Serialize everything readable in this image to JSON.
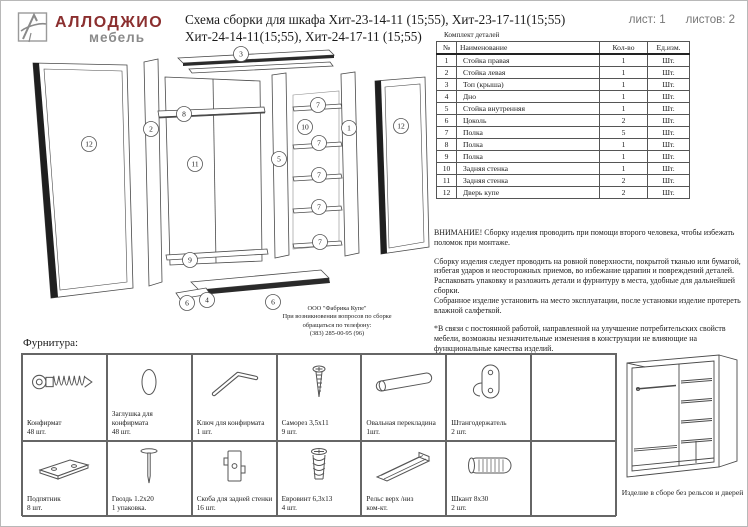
{
  "header": {
    "brand": "АЛЛОДЖИО",
    "brand_sub": "мебель",
    "title_line1": "Схема сборки для шкафа Хит-23-14-11 (15;55), Хит-23-17-11(15;55)",
    "title_line2": "Хит-24-14-11(15;55), Хит-24-17-11 (15;55)",
    "sheet_label": "лист: 1",
    "sheets_label": "листов: 2"
  },
  "colors": {
    "brand": "#8b2f2f",
    "brand_sub": "#8a8a8a",
    "line_art": "#4a4a4a"
  },
  "parts_table": {
    "caption": "Комплект деталей",
    "columns": [
      "№",
      "Наименование",
      "Кол-во",
      "Ед.изм."
    ],
    "rows": [
      [
        "1",
        "Стойка правая",
        "1",
        "Шт."
      ],
      [
        "2",
        "Стойка левая",
        "1",
        "Шт."
      ],
      [
        "3",
        "Топ (крыша)",
        "1",
        "Шт."
      ],
      [
        "4",
        "Дно",
        "1",
        "Шт."
      ],
      [
        "5",
        "Стойка внутренняя",
        "1",
        "Шт."
      ],
      [
        "6",
        "Цоколь",
        "2",
        "Шт."
      ],
      [
        "7",
        "Полка",
        "5",
        "Шт."
      ],
      [
        "8",
        "Полка",
        "1",
        "Шт."
      ],
      [
        "9",
        "Полка",
        "1",
        "Шт."
      ],
      [
        "10",
        "Задняя стенка",
        "1",
        "Шт."
      ],
      [
        "11",
        "Задняя стенка",
        "2",
        "Шт."
      ],
      [
        "12",
        "Дверь купе",
        "2",
        "Шт."
      ]
    ]
  },
  "notes": {
    "warning": "ВНИМАНИЕ! Сборку изделия проводить при помощи второго человека, чтобы избежать поломок при монтаже.",
    "p1": "Сборку изделия следует проводить на ровной поверхности, покрытой тканью или бумагой, избегая ударов и неосторожных приемов, во избежание царапин и повреждений деталей.",
    "p2": "Распаковать упаковку и разложить детали и фурнитуру в места, удобные для дальнейшей сборки.",
    "p3": "Собранное изделие установить на место эксплуатации, после установки изделие протереть влажной салфеткой.",
    "p4": "*В связи с постоянной работой, направленной на улучшение потребительских свойств мебели, возможны незначительные изменения в конструкции не влияющие на функциональные качества изделий."
  },
  "manufacturer": {
    "line1": "ООО \"Фабрика Купе\"",
    "line2": "При возникновении вопросов по сборке",
    "line3": "обращаться по телефону:",
    "line4": "(383) 285-00-95 (96)"
  },
  "diagram": {
    "callouts": {
      "c12_left": "12",
      "c2": "2",
      "c3": "3",
      "c8": "8",
      "c11": "11",
      "c9": "9",
      "c5": "5",
      "c10": "10",
      "c7_1": "7",
      "c7_2": "7",
      "c7_3": "7",
      "c7_4": "7",
      "c7_5": "7",
      "c1": "1",
      "c12_right": "12",
      "c6_left": "6",
      "c4": "4",
      "c6_right": "6"
    }
  },
  "hardware": {
    "caption": "Фурнитура:",
    "row1": [
      {
        "name": "Конфирмат",
        "qty": "48 шт.",
        "icon": "confirmat-screw"
      },
      {
        "name": "Заглушка для конфирмата",
        "qty": "48 шт.",
        "icon": "cap"
      },
      {
        "name": "Ключ для конфирмата",
        "qty": "1 шт.",
        "icon": "hex-key"
      },
      {
        "name": "Саморез 3,5х11",
        "qty": "9 шт.",
        "icon": "small-screw"
      },
      {
        "name": "Овальная перекладина",
        "qty": "1шт.",
        "icon": "oval-rod"
      },
      {
        "name": "Штангодержатель",
        "qty": "2 шт.",
        "icon": "rod-holder"
      }
    ],
    "row2": [
      {
        "name": "Подпятник",
        "qty": "8 шт.",
        "icon": "foot-pad"
      },
      {
        "name": "Гвоздь 1.2х20",
        "qty": "1 упаковка.",
        "icon": "nail"
      },
      {
        "name": "Скоба для задней стенки",
        "qty": "16 шт.",
        "icon": "back-wall-bracket"
      },
      {
        "name": "Евровинт 6,3х13",
        "qty": "4 шт.",
        "icon": "euro-screw"
      },
      {
        "name": "Рельс верх /низ",
        "qty": "ком-кт.",
        "icon": "rail-profile"
      },
      {
        "name": "Шкант 8х30",
        "qty": "2 шт.",
        "icon": "dowel"
      }
    ],
    "assembled_caption": "Изделие в сборе без рельсов и дверей"
  }
}
